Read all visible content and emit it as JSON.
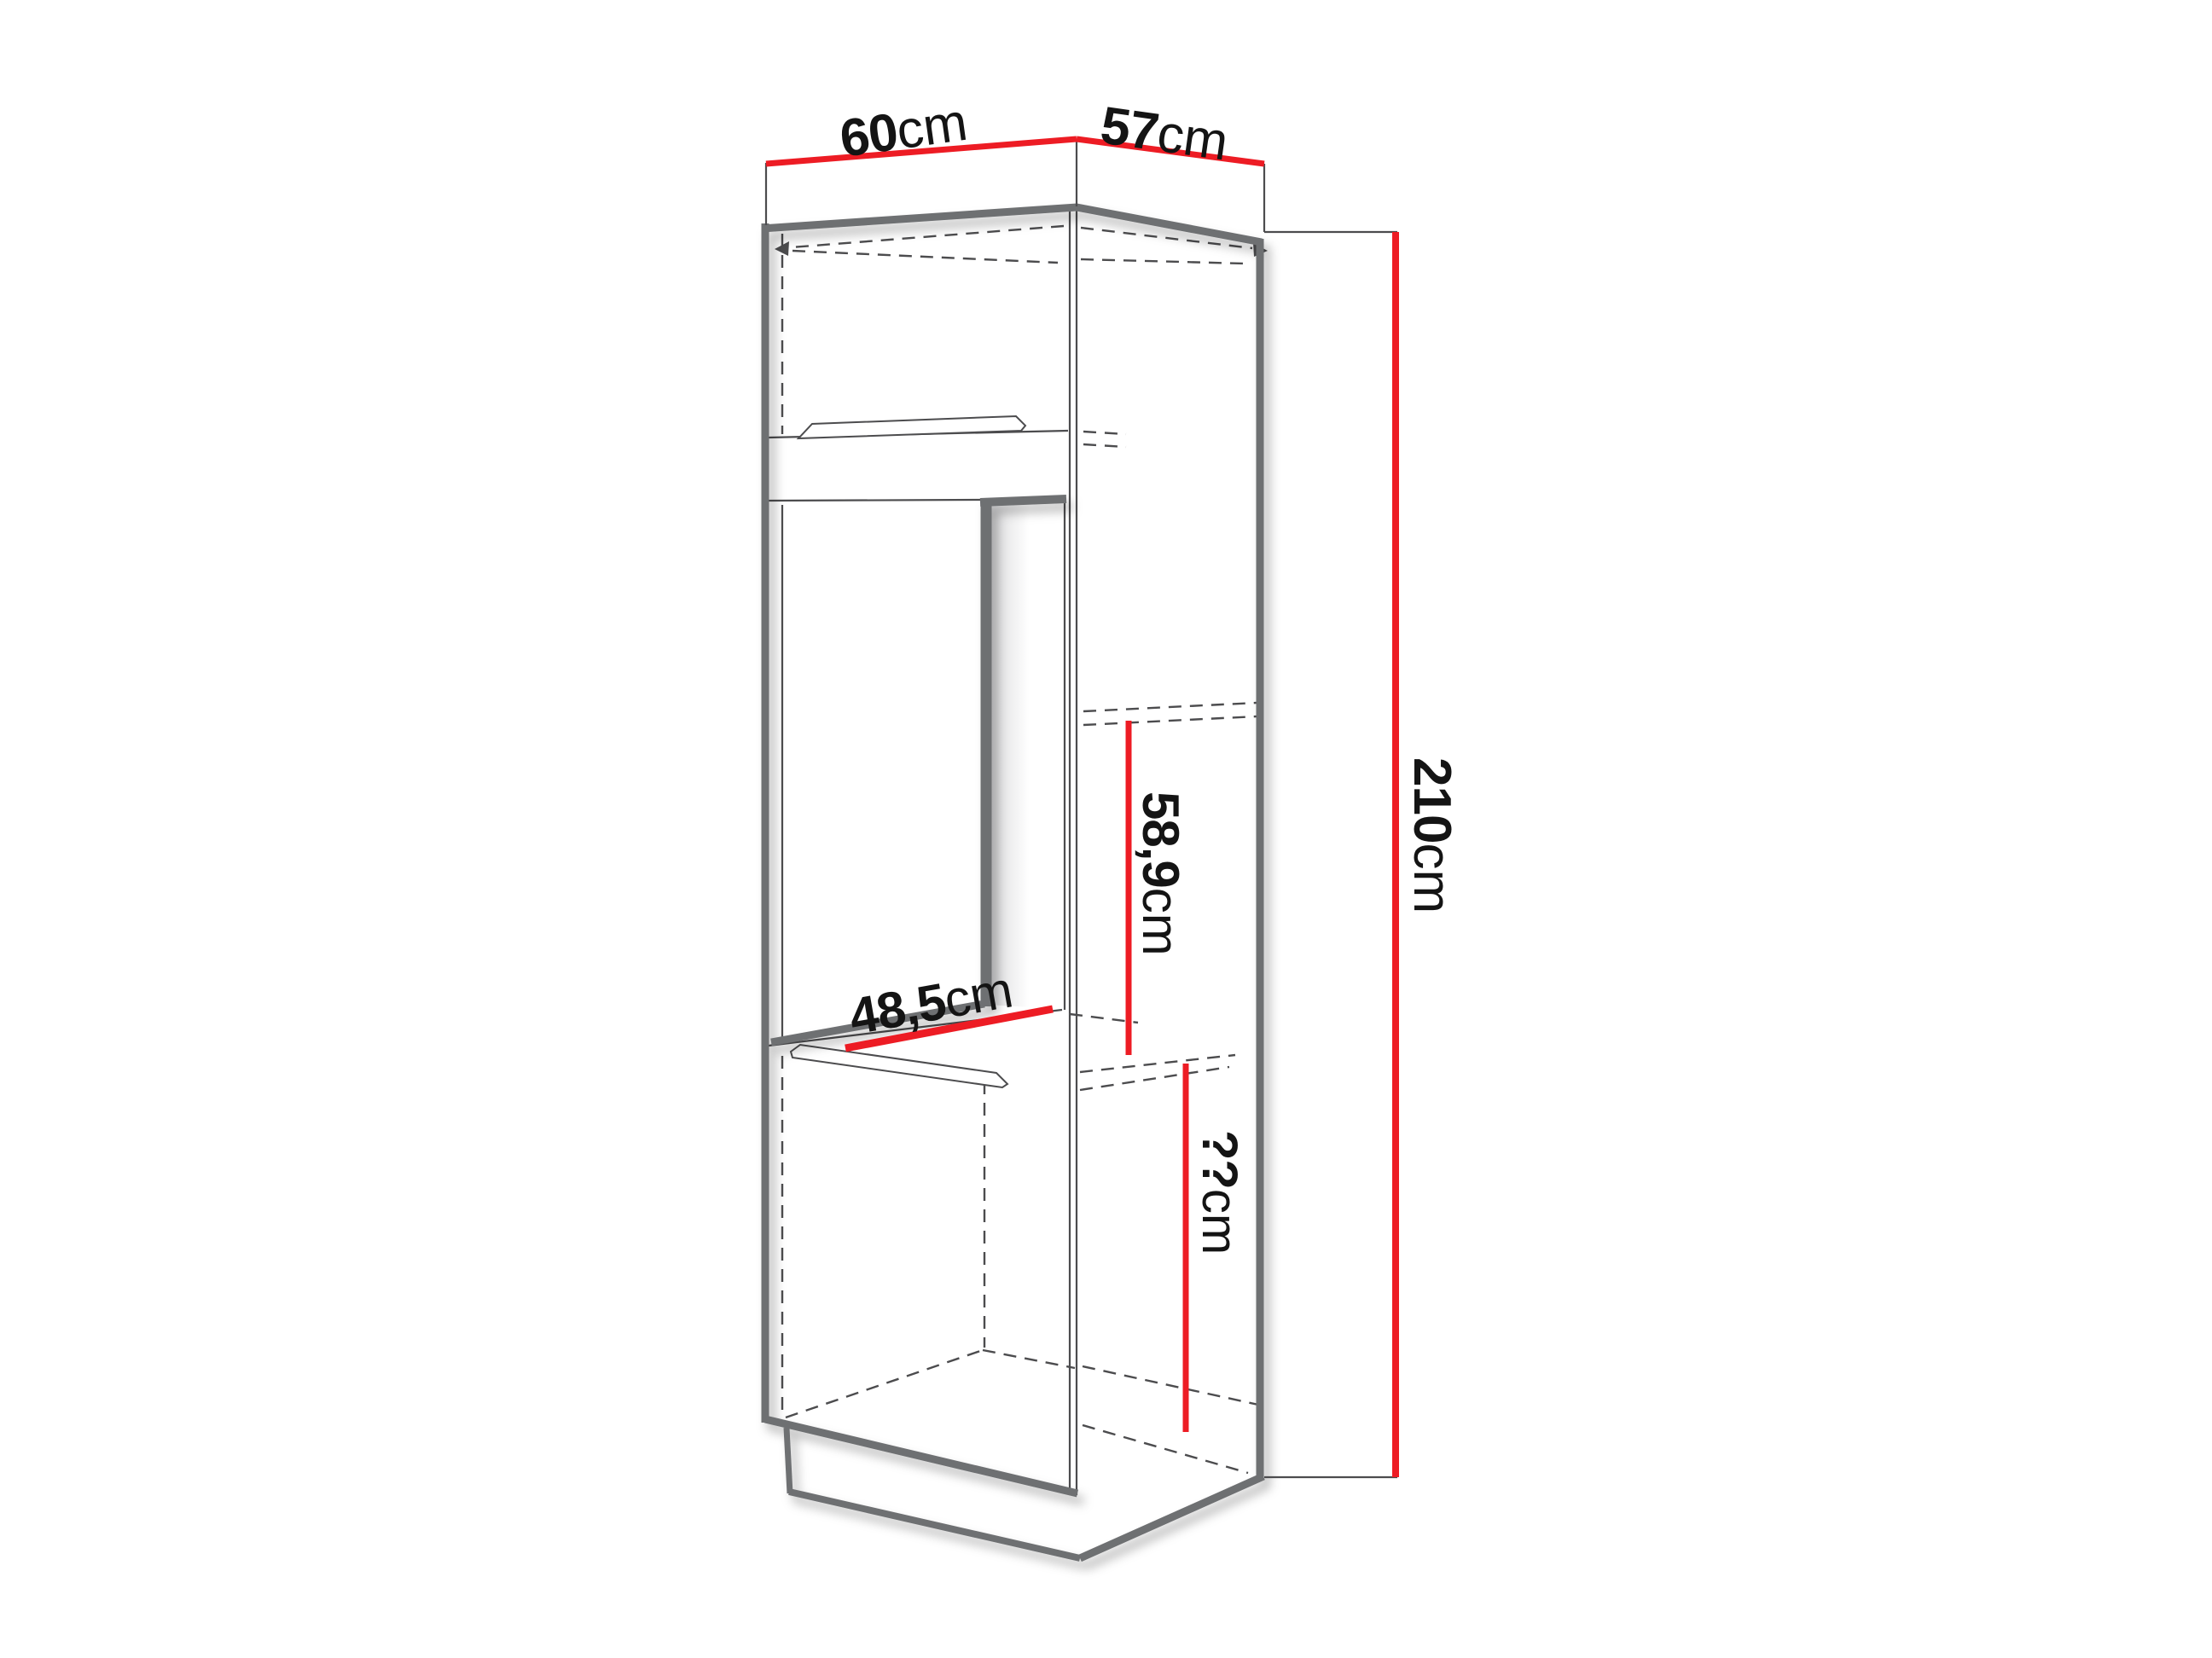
{
  "diagram": {
    "kind": "furniture-cabinet-dimension-drawing"
  },
  "labels": {
    "width_top": {
      "value": "60",
      "unit": "cm"
    },
    "depth_top": {
      "value": "57",
      "unit": "cm"
    },
    "height_total": {
      "value": "210",
      "unit": "cm"
    },
    "niche_height": {
      "value": "58,9",
      "unit": "cm"
    },
    "niche_width": {
      "value": "48,5",
      "unit": "cm"
    },
    "bottom_section_height": {
      "value": "??",
      "unit": "cm"
    }
  },
  "colors": {
    "dimension_red": "#ed1c24",
    "outline_gray": "#6e6f72",
    "line_dark": "#4c4c4e",
    "text_ink": "#141414",
    "background": "#ffffff"
  }
}
